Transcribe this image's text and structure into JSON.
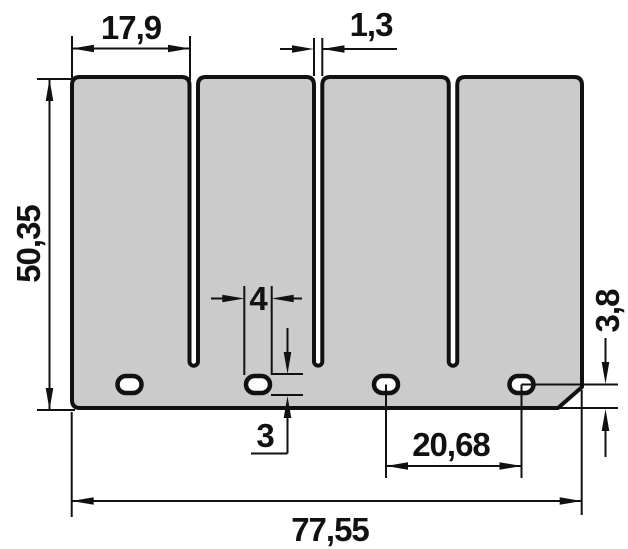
{
  "colors": {
    "plate_fill": "#cbcbcb",
    "hole_fill": "#ffffff",
    "line": "#111111",
    "background": "#ffffff"
  },
  "dimensions": {
    "finger_width": "17,9",
    "slot_width": "1,3",
    "plate_height": "50,35",
    "hole_width": "4",
    "hole_height": "3",
    "hole_center_to_bottom": "3,8",
    "hole_pitch": "20,68",
    "plate_width": "77,55"
  }
}
